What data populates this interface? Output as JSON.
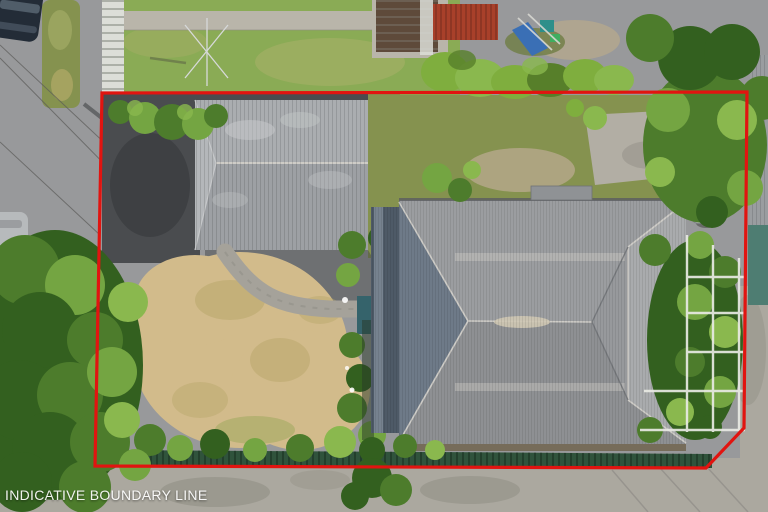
{
  "overlay": {
    "caption": "INDICATIVE BOUNDARY LINE",
    "boundary_points": "102,93 747,92 744,428 706,468 95,466"
  },
  "palette": {
    "boundary_red": "#e11410",
    "caption_white": "#ffffff",
    "road": "#98999b",
    "asphalt": "#4a4c4f",
    "asphalt_shadow": "#3b3d40",
    "concrete": "#aba89f",
    "path_concrete": "#b9b5aa",
    "paver_path": "#a5a29a",
    "garage_top": "#aaadb0",
    "garage_bottom": "#9da0a4",
    "garage_hip": "#b4b7ba",
    "roof_base": "#97999c",
    "roof_left": "#6e7a88",
    "roof_top": "#9b9da0",
    "roof_bottom": "#8e9093",
    "roof_right": "#a9abad",
    "ridge_light": "#ceccc7",
    "ridge_worn": "#cfc8b4",
    "valley_dark": "#6f7276",
    "eave_shadow": "#70644f",
    "veranda": "#4e5a67",
    "veranda_light": "#76828f",
    "lawn": "#8aab55",
    "lawn_olive": "#85924f",
    "lawn_worn": "#a9b06a",
    "lawn_dry": "#d2bb8b",
    "dry_mottle": "#b5a567",
    "hedge": "#7fae3e",
    "hedge_dark": "#577f2a",
    "tree_dark": "#33601f",
    "tree_mid": "#4d7c2c",
    "tree_light": "#74a542",
    "tree_bright": "#8ab84e",
    "fence_green": "#30533c",
    "fence_green_dark": "#1f3a28",
    "fence_white": "#dcded8",
    "shed_red": "#a8402a",
    "shed_red_dark": "#7e2f1f",
    "roof_brown": "#5e4a3a",
    "teal_roof": "#4e7d72",
    "play_blue": "#3a6fb5",
    "play_teal": "#2e8f8a",
    "car_dark": "#232c37",
    "car_window": "#55636f",
    "car_silver": "#b7babc",
    "pergola_white": "#e9eae4",
    "shadow_soft": "#8e8c82",
    "dirt": "#b7a98c",
    "chimney": "#8f9295",
    "dish": "#c8cbcd",
    "wire": "#5a5a58",
    "teal_box": "#35636b"
  }
}
